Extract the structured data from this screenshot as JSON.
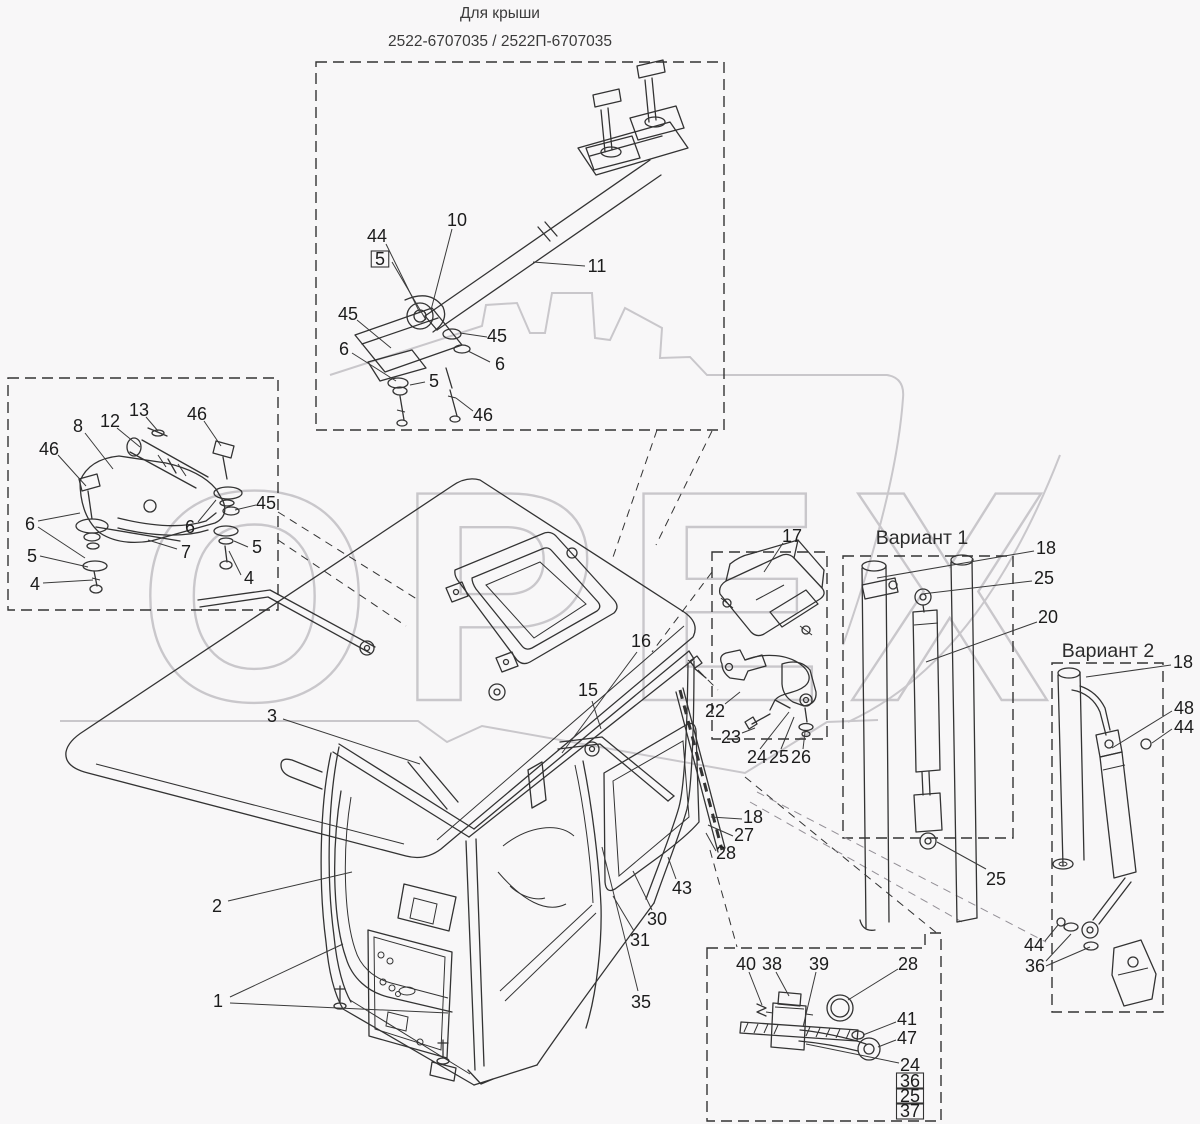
{
  "header": {
    "line1": "Для крыши",
    "line2": "2522-6707035 / 2522П-6707035"
  },
  "watermark": {
    "text": "ОРЕХ"
  },
  "variants": {
    "v1": "Вариант 1",
    "v2": "Вариант 2"
  },
  "colors": {
    "line": "#333333",
    "label": "#1c1c1c",
    "watermark": "#c9c7cb",
    "background": "#f8f7f8"
  },
  "callouts": [
    {
      "text": "44",
      "x": 377,
      "y": 236,
      "boxed": false,
      "leaders": [
        [
          386,
          244,
          420,
          313
        ]
      ]
    },
    {
      "text": "5",
      "x": 380,
      "y": 259,
      "boxed": true,
      "leaders": [
        [
          392,
          262,
          426,
          320
        ]
      ]
    },
    {
      "text": "10",
      "x": 457,
      "y": 220,
      "boxed": false,
      "leaders": [
        [
          452,
          229,
          431,
          310
        ]
      ]
    },
    {
      "text": "11",
      "x": 597,
      "y": 266,
      "boxed": false,
      "leaders": [
        [
          585,
          266,
          533,
          262
        ]
      ]
    },
    {
      "text": "45",
      "x": 348,
      "y": 314,
      "boxed": false,
      "leaders": [
        [
          357,
          320,
          391,
          348
        ]
      ]
    },
    {
      "text": "6",
      "x": 344,
      "y": 349,
      "boxed": false,
      "leaders": [
        [
          352,
          353,
          396,
          381
        ]
      ]
    },
    {
      "text": "5",
      "x": 434,
      "y": 381,
      "boxed": false,
      "leaders": [
        [
          425,
          382,
          410,
          385
        ]
      ]
    },
    {
      "text": "45",
      "x": 497,
      "y": 336,
      "boxed": false,
      "leaders": [
        [
          487,
          337,
          460,
          333
        ]
      ]
    },
    {
      "text": "6",
      "x": 500,
      "y": 364,
      "boxed": false,
      "leaders": [
        [
          490,
          362,
          468,
          351
        ]
      ]
    },
    {
      "text": "46",
      "x": 483,
      "y": 415,
      "boxed": false,
      "leaders": [
        [
          473,
          411,
          456,
          398
        ]
      ]
    },
    {
      "text": "46",
      "x": 49,
      "y": 449,
      "boxed": false,
      "leaders": [
        [
          58,
          455,
          86,
          486
        ]
      ]
    },
    {
      "text": "8",
      "x": 78,
      "y": 426,
      "boxed": false,
      "leaders": [
        [
          85,
          433,
          113,
          469
        ]
      ]
    },
    {
      "text": "12",
      "x": 110,
      "y": 421,
      "boxed": false,
      "leaders": [
        [
          117,
          428,
          140,
          447
        ]
      ]
    },
    {
      "text": "13",
      "x": 139,
      "y": 410,
      "boxed": false,
      "leaders": [
        [
          146,
          417,
          158,
          431
        ]
      ]
    },
    {
      "text": "46",
      "x": 197,
      "y": 414,
      "boxed": false,
      "leaders": [
        [
          204,
          421,
          221,
          446
        ]
      ]
    },
    {
      "text": "45",
      "x": 266,
      "y": 503,
      "boxed": false,
      "leaders": [
        [
          256,
          505,
          235,
          510
        ]
      ]
    },
    {
      "text": "6",
      "x": 30,
      "y": 524,
      "boxed": false,
      "leaders": [
        [
          38,
          521,
          80,
          513
        ],
        [
          38,
          527,
          85,
          558
        ]
      ]
    },
    {
      "text": "5",
      "x": 32,
      "y": 556,
      "boxed": false,
      "leaders": [
        [
          40,
          556,
          88,
          567
        ]
      ]
    },
    {
      "text": "4",
      "x": 35,
      "y": 584,
      "boxed": false,
      "leaders": [
        [
          43,
          583,
          93,
          580
        ]
      ]
    },
    {
      "text": "6",
      "x": 190,
      "y": 527,
      "boxed": false,
      "leaders": [
        [
          198,
          522,
          216,
          500
        ]
      ]
    },
    {
      "text": "7",
      "x": 186,
      "y": 552,
      "boxed": false,
      "leaders": [
        [
          177,
          549,
          148,
          540
        ]
      ]
    },
    {
      "text": "5",
      "x": 257,
      "y": 547,
      "boxed": false,
      "leaders": [
        [
          248,
          547,
          234,
          541
        ]
      ]
    },
    {
      "text": "4",
      "x": 249,
      "y": 578,
      "boxed": false,
      "leaders": [
        [
          241,
          575,
          229,
          551
        ]
      ]
    },
    {
      "text": "3",
      "x": 272,
      "y": 716,
      "boxed": false,
      "leaders": [
        [
          283,
          719,
          420,
          764
        ]
      ]
    },
    {
      "text": "2",
      "x": 217,
      "y": 906,
      "boxed": false,
      "leaders": [
        [
          228,
          901,
          352,
          872
        ]
      ]
    },
    {
      "text": "1",
      "x": 218,
      "y": 1001,
      "boxed": false,
      "leaders": [
        [
          230,
          997,
          343,
          944
        ],
        [
          230,
          1003,
          448,
          1013
        ]
      ]
    },
    {
      "text": "16",
      "x": 641,
      "y": 641,
      "boxed": false,
      "leaders": [
        [
          637,
          652,
          562,
          753
        ]
      ]
    },
    {
      "text": "15",
      "x": 588,
      "y": 690,
      "boxed": false,
      "leaders": [
        [
          592,
          701,
          601,
          729
        ]
      ]
    },
    {
      "text": "17",
      "x": 792,
      "y": 536,
      "boxed": false,
      "leaders": [
        [
          783,
          543,
          764,
          572
        ]
      ]
    },
    {
      "text": "22",
      "x": 715,
      "y": 711,
      "boxed": false,
      "leaders": [
        [
          725,
          704,
          740,
          692
        ]
      ]
    },
    {
      "text": "23",
      "x": 731,
      "y": 737,
      "boxed": false,
      "leaders": [
        [
          742,
          733,
          755,
          728
        ]
      ]
    },
    {
      "text": "24",
      "x": 757,
      "y": 757,
      "boxed": false,
      "leaders": [
        [
          760,
          749,
          789,
          712
        ]
      ]
    },
    {
      "text": "25",
      "x": 779,
      "y": 757,
      "boxed": false,
      "leaders": [
        [
          781,
          749,
          794,
          717
        ]
      ]
    },
    {
      "text": "26",
      "x": 801,
      "y": 757,
      "boxed": false,
      "leaders": [
        [
          803,
          749,
          805,
          732
        ]
      ]
    },
    {
      "text": "18",
      "x": 753,
      "y": 817,
      "boxed": false,
      "leaders": [
        [
          742,
          819,
          711,
          817
        ]
      ]
    },
    {
      "text": "27",
      "x": 744,
      "y": 835,
      "boxed": false,
      "leaders": [
        [
          733,
          836,
          708,
          825
        ]
      ]
    },
    {
      "text": "28",
      "x": 726,
      "y": 853,
      "boxed": false,
      "leaders": [
        [
          716,
          851,
          706,
          833
        ]
      ]
    },
    {
      "text": "43",
      "x": 682,
      "y": 888,
      "boxed": false,
      "leaders": [
        [
          676,
          879,
          668,
          857
        ]
      ]
    },
    {
      "text": "30",
      "x": 657,
      "y": 919,
      "boxed": false,
      "leaders": [
        [
          652,
          910,
          633,
          871
        ]
      ]
    },
    {
      "text": "31",
      "x": 640,
      "y": 940,
      "boxed": false,
      "leaders": [
        [
          634,
          931,
          613,
          896
        ]
      ]
    },
    {
      "text": "35",
      "x": 641,
      "y": 1002,
      "boxed": false,
      "leaders": [
        [
          638,
          991,
          602,
          847
        ]
      ]
    },
    {
      "text": "18",
      "x": 1046,
      "y": 548,
      "boxed": false,
      "leaders": [
        [
          1034,
          551,
          877,
          578
        ]
      ]
    },
    {
      "text": "25",
      "x": 1044,
      "y": 578,
      "boxed": false,
      "leaders": [
        [
          1032,
          581,
          922,
          594
        ]
      ]
    },
    {
      "text": "20",
      "x": 1048,
      "y": 617,
      "boxed": false,
      "leaders": [
        [
          1037,
          622,
          926,
          662
        ]
      ]
    },
    {
      "text": "25",
      "x": 996,
      "y": 879,
      "boxed": false,
      "leaders": [
        [
          986,
          869,
          937,
          842
        ]
      ]
    },
    {
      "text": "18",
      "x": 1183,
      "y": 662,
      "boxed": false,
      "leaders": [
        [
          1171,
          665,
          1086,
          677
        ]
      ]
    },
    {
      "text": "48",
      "x": 1184,
      "y": 708,
      "boxed": false,
      "leaders": [
        [
          1172,
          711,
          1112,
          748
        ]
      ]
    },
    {
      "text": "44",
      "x": 1184,
      "y": 727,
      "boxed": false,
      "leaders": [
        [
          1172,
          729,
          1152,
          743
        ]
      ]
    },
    {
      "text": "44",
      "x": 1034,
      "y": 945,
      "boxed": false,
      "leaders": [
        [
          1045,
          941,
          1058,
          925
        ]
      ]
    },
    {
      "text": "36",
      "x": 1035,
      "y": 966,
      "boxed": false,
      "leaders": [
        [
          1046,
          961,
          1071,
          934
        ],
        [
          1046,
          966,
          1090,
          947
        ]
      ]
    },
    {
      "text": "40",
      "x": 746,
      "y": 964,
      "boxed": false,
      "leaders": [
        [
          749,
          972,
          762,
          1005
        ]
      ]
    },
    {
      "text": "38",
      "x": 772,
      "y": 964,
      "boxed": false,
      "leaders": [
        [
          776,
          972,
          789,
          996
        ]
      ]
    },
    {
      "text": "39",
      "x": 819,
      "y": 964,
      "boxed": false,
      "leaders": [
        [
          816,
          972,
          803,
          1027
        ]
      ]
    },
    {
      "text": "28",
      "x": 908,
      "y": 964,
      "boxed": false,
      "leaders": [
        [
          898,
          969,
          848,
          1000
        ]
      ]
    },
    {
      "text": "41",
      "x": 907,
      "y": 1019,
      "boxed": false,
      "leaders": [
        [
          896,
          1022,
          863,
          1035
        ]
      ]
    },
    {
      "text": "47",
      "x": 907,
      "y": 1038,
      "boxed": false,
      "leaders": [
        [
          896,
          1040,
          878,
          1047
        ]
      ]
    },
    {
      "text": "24",
      "x": 910,
      "y": 1065,
      "boxed": false,
      "leaders": [
        [
          899,
          1063,
          806,
          1044
        ]
      ]
    },
    {
      "text": "36",
      "x": 910,
      "y": 1081,
      "boxed": true,
      "leaders": []
    },
    {
      "text": "25",
      "x": 910,
      "y": 1096,
      "boxed": true,
      "leaders": []
    },
    {
      "text": "37",
      "x": 910,
      "y": 1111,
      "boxed": true,
      "leaders": []
    }
  ]
}
